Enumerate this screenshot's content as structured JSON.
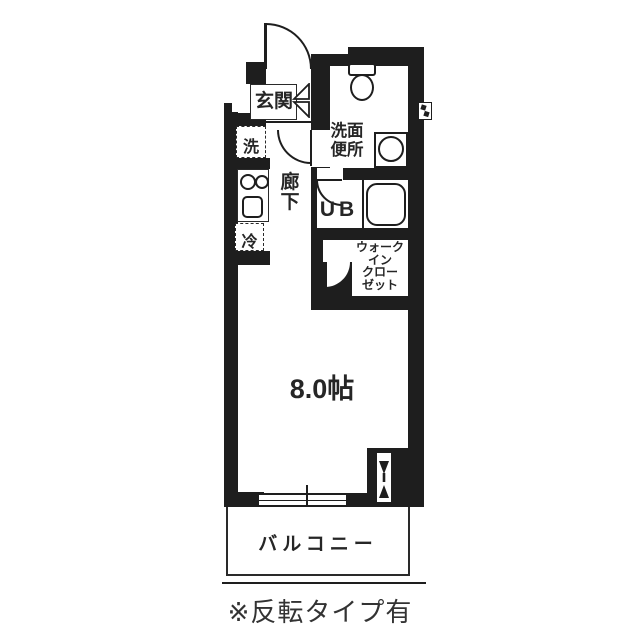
{
  "floorplan": {
    "labels": {
      "genkan": "玄関",
      "washer": "洗",
      "fridge": "冷",
      "hallway": [
        "廊",
        "下"
      ],
      "washroom": [
        "洗面",
        "便所"
      ],
      "unit_bath": "UB",
      "closet": [
        "ウォーク",
        "イン",
        "クロー",
        "ゼット"
      ],
      "main_room": "8.0帖",
      "balcony": "バルコニー"
    },
    "caption": "※反転タイプ有",
    "colors": {
      "wall": "#1e1e1e",
      "background": "#ffffff"
    }
  }
}
